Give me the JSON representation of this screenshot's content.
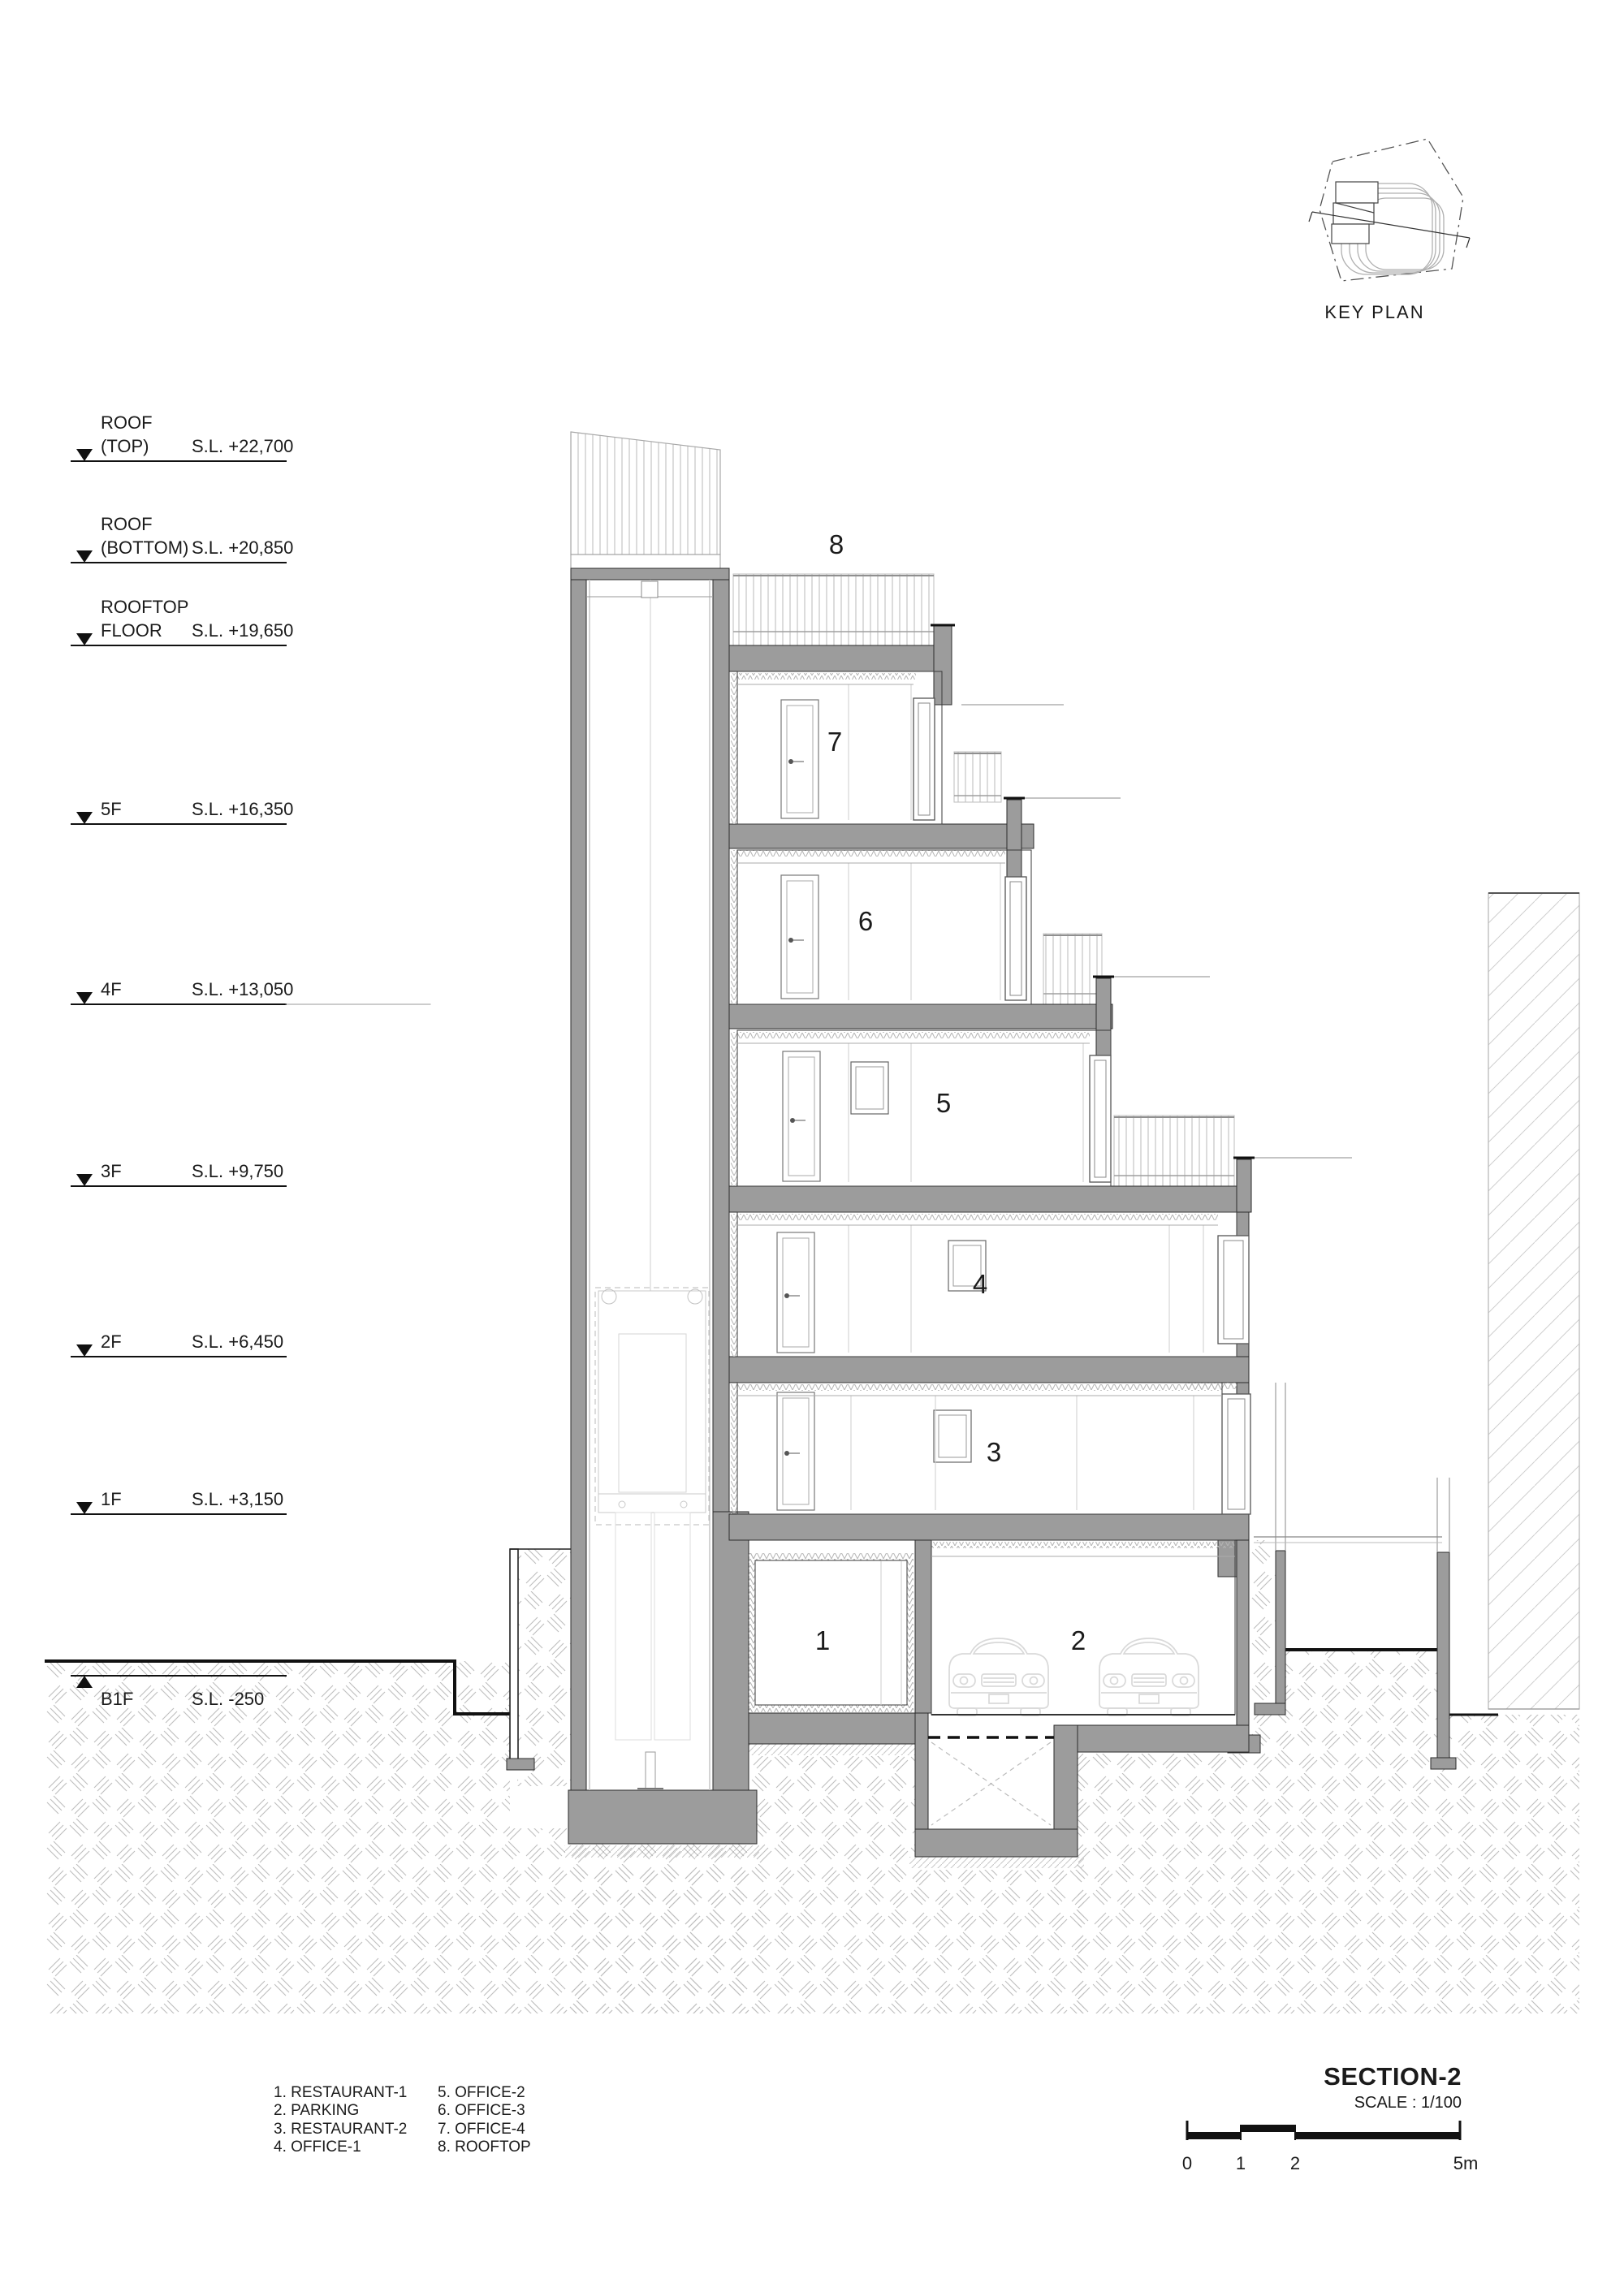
{
  "drawing": {
    "key_plan_label": "KEY PLAN",
    "section_title": "SECTION-2",
    "scale_label": "SCALE : 1/100"
  },
  "levels": [
    {
      "name1": "ROOF",
      "name2": "(TOP)",
      "sl": "S.L. +22,700"
    },
    {
      "name1": "ROOF",
      "name2": "(BOTTOM)",
      "sl": "S.L. +20,850"
    },
    {
      "name1": "ROOFTOP",
      "name2": "FLOOR",
      "sl": "S.L. +19,650"
    },
    {
      "name1": "5F",
      "name2": "",
      "sl": "S.L. +16,350"
    },
    {
      "name1": "4F",
      "name2": "",
      "sl": "S.L. +13,050"
    },
    {
      "name1": "3F",
      "name2": "",
      "sl": "S.L. +9,750"
    },
    {
      "name1": "2F",
      "name2": "",
      "sl": "S.L. +6,450"
    },
    {
      "name1": "1F",
      "name2": "",
      "sl": "S.L. +3,150"
    },
    {
      "name1": "B1F",
      "name2": "",
      "sl": "S.L. -250"
    }
  ],
  "rooms": [
    {
      "n": "1"
    },
    {
      "n": "2"
    },
    {
      "n": "3"
    },
    {
      "n": "4"
    },
    {
      "n": "5"
    },
    {
      "n": "6"
    },
    {
      "n": "7"
    },
    {
      "n": "8"
    }
  ],
  "legend": {
    "col1": [
      "1. RESTAURANT-1",
      "2. PARKING",
      "3. RESTAURANT-2",
      "4. OFFICE-1"
    ],
    "col2": [
      "5. OFFICE-2",
      "6. OFFICE-3",
      "7. OFFICE-4",
      "8. ROOFTOP"
    ]
  },
  "scalebar": {
    "t0": "0",
    "t1": "1",
    "t2": "2",
    "t5": "5m"
  },
  "colors": {
    "poche": "#9c9c9c",
    "ink": "#1b1b1b",
    "hatch": "#b9b9b9",
    "light": "#d6d6d6"
  }
}
